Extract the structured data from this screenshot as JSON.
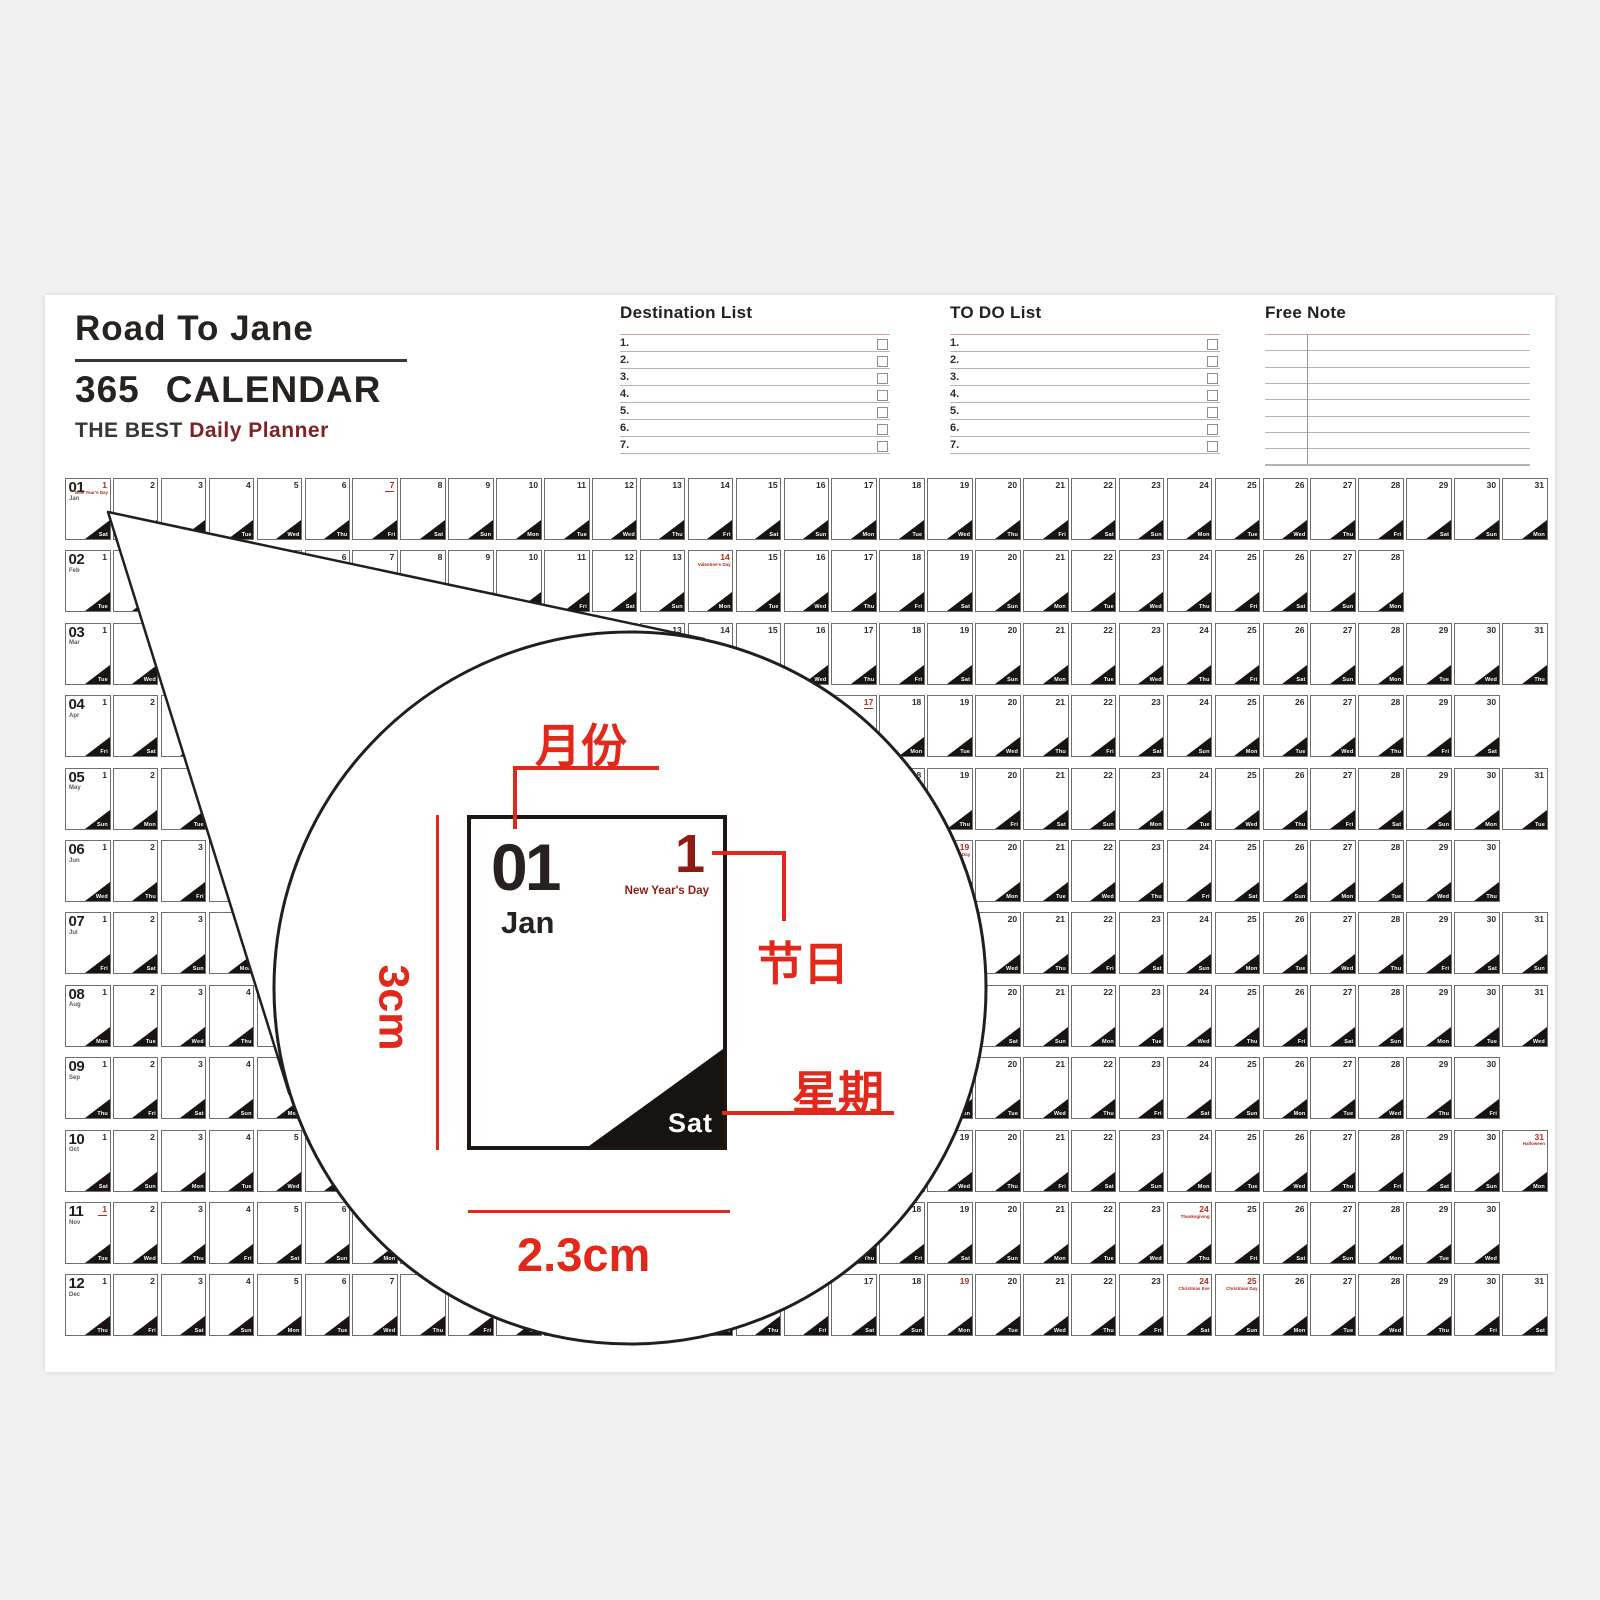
{
  "header": {
    "brand": "Road To Jane",
    "title_number": "365",
    "title_word": "CALENDAR",
    "subtitle_prefix": "THE BEST",
    "subtitle_accent": "Daily Planner"
  },
  "lists": {
    "destination": {
      "title": "Destination List",
      "items": [
        "1.",
        "2.",
        "3.",
        "4.",
        "5.",
        "6.",
        "7."
      ]
    },
    "todo": {
      "title": "TO DO List",
      "items": [
        "1.",
        "2.",
        "3.",
        "4.",
        "5.",
        "6.",
        "7."
      ]
    },
    "free_note": {
      "title": "Free Note",
      "line_count": 8
    }
  },
  "calendar": {
    "weekday_labels": [
      "Sun",
      "Mon",
      "Tue",
      "Wed",
      "Thu",
      "Fri",
      "Sat"
    ],
    "months": [
      {
        "num": "01",
        "abbr": "Jan",
        "days": 31,
        "start_weekday": 6,
        "red_days": [
          {
            "day": 1,
            "label": "New Year's Day"
          },
          {
            "day": 7,
            "label": "",
            "mark": true
          }
        ]
      },
      {
        "num": "02",
        "abbr": "Feb",
        "days": 28,
        "start_weekday": 2,
        "red_days": [
          {
            "day": 14,
            "label": "Valentine's Day"
          }
        ]
      },
      {
        "num": "03",
        "abbr": "Mar",
        "days": 31,
        "start_weekday": 2,
        "red_days": []
      },
      {
        "num": "04",
        "abbr": "Apr",
        "days": 30,
        "start_weekday": 5,
        "red_days": [
          {
            "day": 17,
            "label": "",
            "mark": true
          }
        ]
      },
      {
        "num": "05",
        "abbr": "May",
        "days": 31,
        "start_weekday": 0,
        "red_days": []
      },
      {
        "num": "06",
        "abbr": "Jun",
        "days": 30,
        "start_weekday": 3,
        "red_days": [
          {
            "day": 19,
            "label": "Father's Day"
          }
        ]
      },
      {
        "num": "07",
        "abbr": "Jul",
        "days": 31,
        "start_weekday": 5,
        "red_days": []
      },
      {
        "num": "08",
        "abbr": "Aug",
        "days": 31,
        "start_weekday": 1,
        "red_days": []
      },
      {
        "num": "09",
        "abbr": "Sep",
        "days": 30,
        "start_weekday": 4,
        "red_days": []
      },
      {
        "num": "10",
        "abbr": "Oct",
        "days": 31,
        "start_weekday": 6,
        "red_days": [
          {
            "day": 31,
            "label": "Halloween"
          }
        ]
      },
      {
        "num": "11",
        "abbr": "Nov",
        "days": 30,
        "start_weekday": 2,
        "red_days": [
          {
            "day": 1,
            "label": "",
            "mark": true
          },
          {
            "day": 24,
            "label": "Thanksgiving"
          }
        ]
      },
      {
        "num": "12",
        "abbr": "Dec",
        "days": 31,
        "start_weekday": 4,
        "red_days": [
          {
            "day": 19,
            "label": ""
          },
          {
            "day": 24,
            "label": "Christmas Eve"
          },
          {
            "day": 25,
            "label": "Christmas Day"
          }
        ]
      }
    ]
  },
  "magnifier": {
    "month_num": "01",
    "month_abbr": "Jan",
    "holiday_day": "1",
    "holiday_name": "New Year's Day",
    "weekday": "Sat",
    "label_month": "月份",
    "label_holiday": "节日",
    "label_weekday": "星期",
    "dim_height": "3cm",
    "dim_width": "2.3cm"
  },
  "colors": {
    "annotation_red": "#e2281b",
    "holiday_red": "#8e1c12",
    "day_red": "#b5281c",
    "subtitle_maroon": "#7d2324",
    "ink": "#262220"
  }
}
